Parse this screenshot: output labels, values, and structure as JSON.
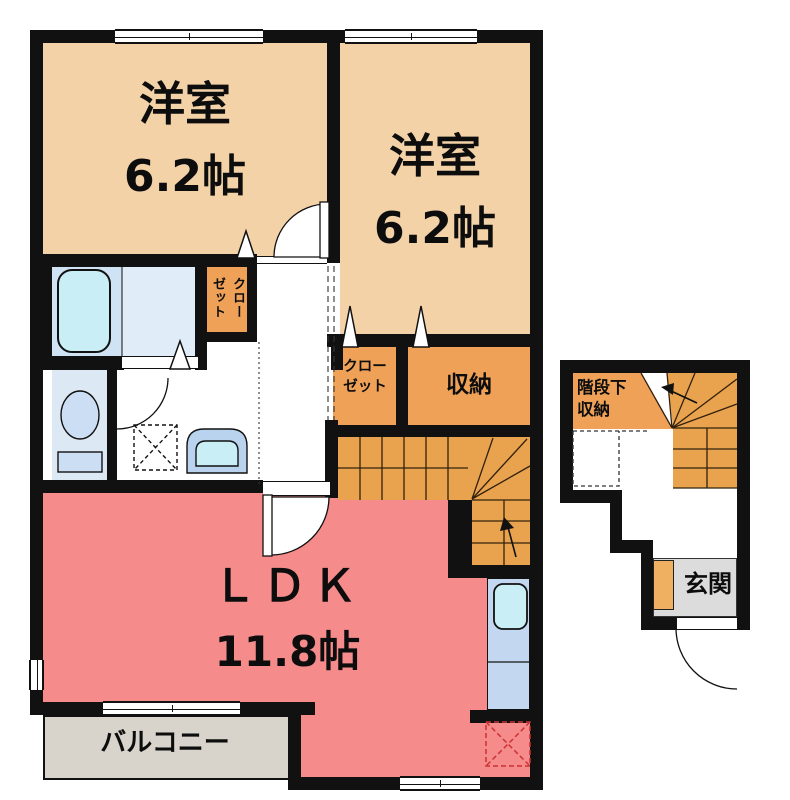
{
  "title": "apartment-floor-plan",
  "rooms": {
    "bedroom1": {
      "name": "洋室",
      "size": "6.2帖"
    },
    "bedroom2": {
      "name": "洋室",
      "size": "6.2帖"
    },
    "ldk": {
      "name": "ＬＤＫ",
      "size": "11.8帖"
    },
    "balcony": {
      "name": "バルコニー"
    },
    "closet_vertical": {
      "name": "クロー\nゼット"
    },
    "closet2": {
      "name": "クロー\nゼット"
    },
    "storage": {
      "name": "収納"
    },
    "under_stairs_storage": {
      "name": "階段下\n収納"
    },
    "entrance": {
      "name": "玄関"
    }
  },
  "fixtures": {
    "bathtub": "bathtub-icon",
    "toilet": "toilet-icon",
    "washbasin": "washbasin-icon",
    "kitchen_sink": "kitchen-sink-icon",
    "washer_pan": "washing-machine-pan-icon",
    "refrigerator_space": "refrigerator-space-icon",
    "stairs": "stairs-icon",
    "door_swings": "door-swing-icon"
  },
  "colors": {
    "wall": "#111111",
    "bedroom": "#f4d2a8",
    "storage_orange": "#efa257",
    "stairs_orange": "#e9a34f",
    "ldk_pink": "#f58b8b",
    "balcony_gray": "#d8d4cc",
    "entrance_gray": "#dcdcdc",
    "bath_blue": "#cfe3f4",
    "bath_blue_light": "#e0edf8",
    "toilet_blue": "#dde8f5",
    "counter_blue": "#c3d8f0",
    "sink_cyan": "#c9eef6",
    "fridge_dash_red": "#cc3333"
  }
}
